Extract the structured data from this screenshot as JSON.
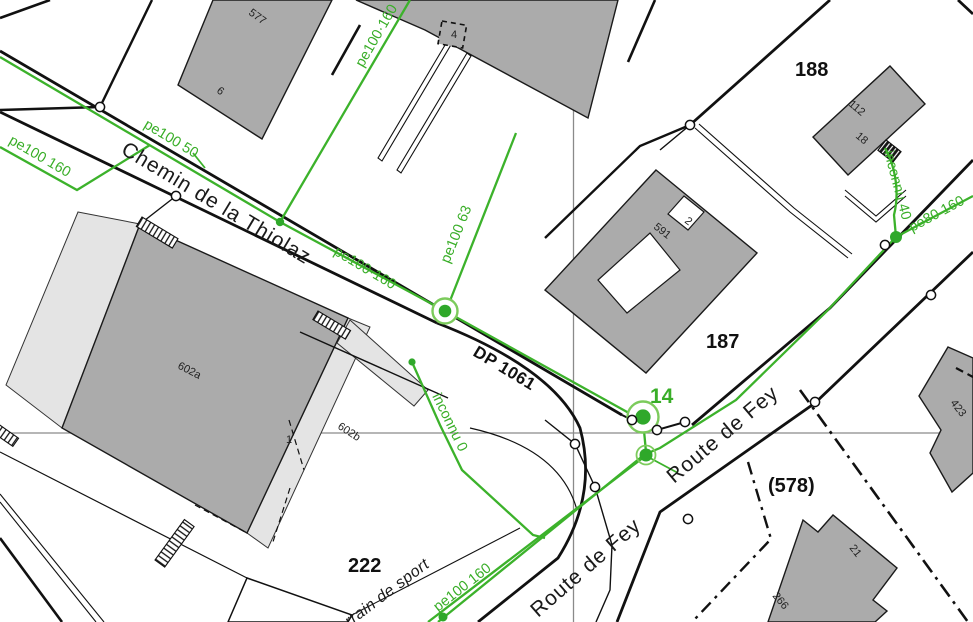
{
  "map": {
    "parcels": {
      "p188": "188",
      "p187": "187",
      "p222": "222",
      "p578": "(578)",
      "p14": "14"
    },
    "buildings": {
      "b577": "577",
      "b6": "6",
      "b4": "4",
      "b112": "112",
      "b18": "18",
      "b591": "591",
      "b2": "2",
      "b602a": "602a",
      "b602b": "602b",
      "b1": "1",
      "b21": "21",
      "b266": "266",
      "b423": "423"
    },
    "streets": {
      "chemin": "Chemin de la Thiolaz",
      "dp": "DP 1061",
      "route_fey_upper": "Route de Fey",
      "route_fey_lower": "Route de Fey",
      "terrain": "Terrain de sport"
    },
    "pipes": {
      "pe100_160_left": "pe100 160",
      "pe100_50": "pe100 50",
      "pe100_160_branch": "pe100·160",
      "pe100_160_main": "pe100·160",
      "pe100_63": "pe100 63",
      "inconnu_0": "inconnu 0",
      "inconnu_40": "inconnu 40",
      "pe80_160": "pe80 160",
      "pe100_160_bottom": "pe100 160"
    },
    "colors": {
      "pipe_green": "#3CB22B",
      "building_fill": "#ABABAB",
      "building_light": "#E4E4E4",
      "grid": "#8A8A8A"
    }
  }
}
